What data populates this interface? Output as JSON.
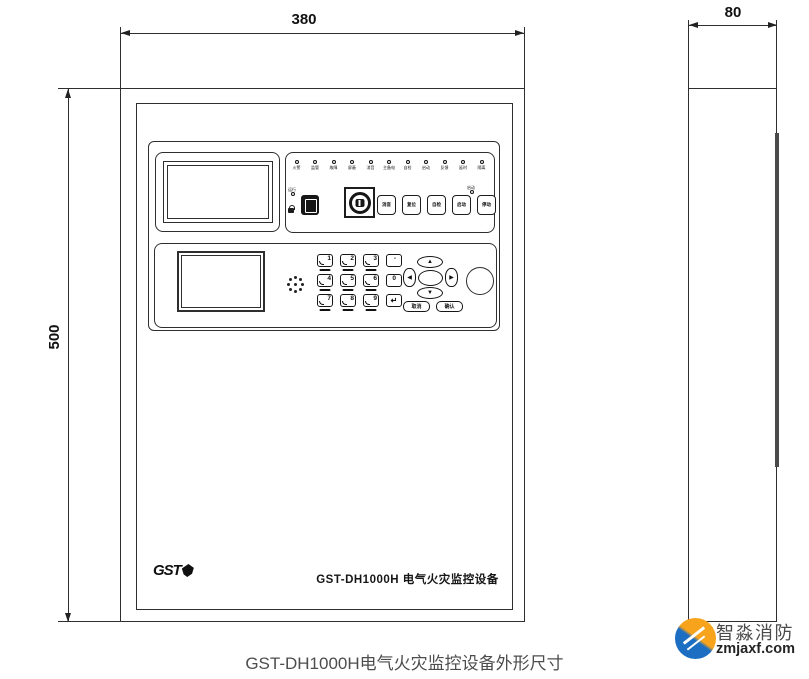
{
  "page": {
    "caption": "GST-DH1000H电气火灾监控设备外形尺寸"
  },
  "dimensions": {
    "front_width": "380",
    "front_height": "500",
    "side_depth": "80"
  },
  "front_panel": {
    "logo": "GST",
    "device_name": "GST-DH1000H 电气火灾监控设备",
    "led_labels": [
      "火警",
      "监管",
      "故障",
      "屏蔽",
      "消音",
      "主备电",
      "自检",
      "启动",
      "反馈",
      "延时",
      "隔离"
    ],
    "aux_led_label": "运行",
    "btn_led_label": "启动",
    "key_buttons": [
      "消音",
      "复位",
      "自检",
      "启动",
      "停动"
    ]
  },
  "keypad": {
    "keys": [
      "1",
      "2",
      "3",
      "-",
      "4",
      "5",
      "6",
      "0",
      "7",
      "8",
      "9",
      "↵"
    ]
  },
  "nav": {
    "up": "▲",
    "down": "▼",
    "left": "◀",
    "right": "▶",
    "btn_cancel": "取消",
    "btn_ok": "确认"
  },
  "watermark": {
    "name": "智淼消防",
    "site": "zmjaxf.com"
  }
}
